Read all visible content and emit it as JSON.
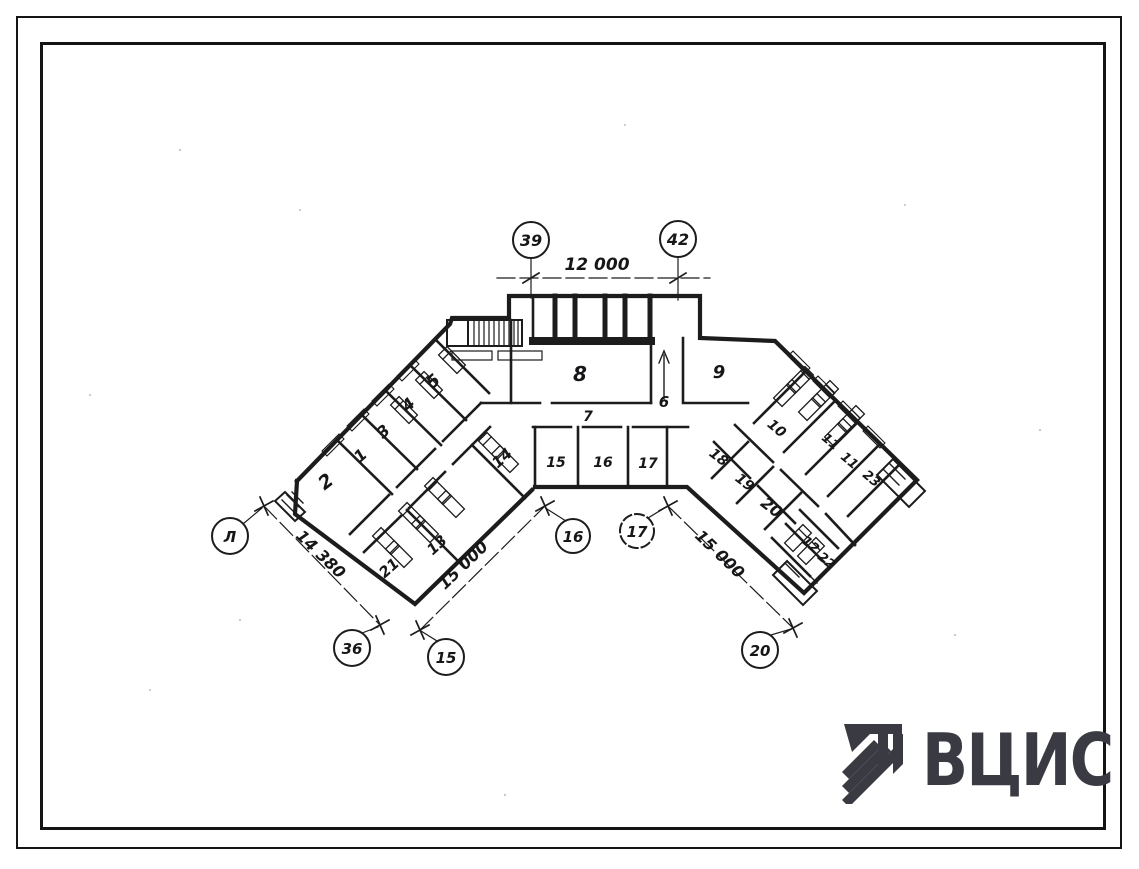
{
  "page": {
    "background": "#ffffff",
    "ink": "#1a1a1a"
  },
  "logo": {
    "text": "ВЦИС",
    "color": "#3a3a43",
    "icon": "vcis-stripes-mark"
  },
  "plan": {
    "rooms": [
      {
        "label": "2"
      },
      {
        "label": "1"
      },
      {
        "label": "3"
      },
      {
        "label": "4"
      },
      {
        "label": "5"
      },
      {
        "label": "21"
      },
      {
        "label": "13"
      },
      {
        "label": "14"
      },
      {
        "label": "8"
      },
      {
        "label": "6"
      },
      {
        "label": "7"
      },
      {
        "label": "9"
      },
      {
        "label": "15"
      },
      {
        "label": "16"
      },
      {
        "label": "17"
      },
      {
        "label": "18"
      },
      {
        "label": "19"
      },
      {
        "label": "20"
      },
      {
        "label": "10"
      },
      {
        "label": "11"
      },
      {
        "label": "11"
      },
      {
        "label": "23"
      },
      {
        "label": "12"
      },
      {
        "label": "22"
      }
    ],
    "axis_markers": [
      {
        "label": "39"
      },
      {
        "label": "42"
      },
      {
        "label": "Л"
      },
      {
        "label": "36"
      },
      {
        "label": "15"
      },
      {
        "label": "16"
      },
      {
        "label": "17"
      },
      {
        "label": "20"
      }
    ],
    "dimensions": [
      {
        "label": "12 000"
      },
      {
        "label": "14 380"
      },
      {
        "label": "15 000"
      },
      {
        "label": "15 000"
      }
    ]
  }
}
